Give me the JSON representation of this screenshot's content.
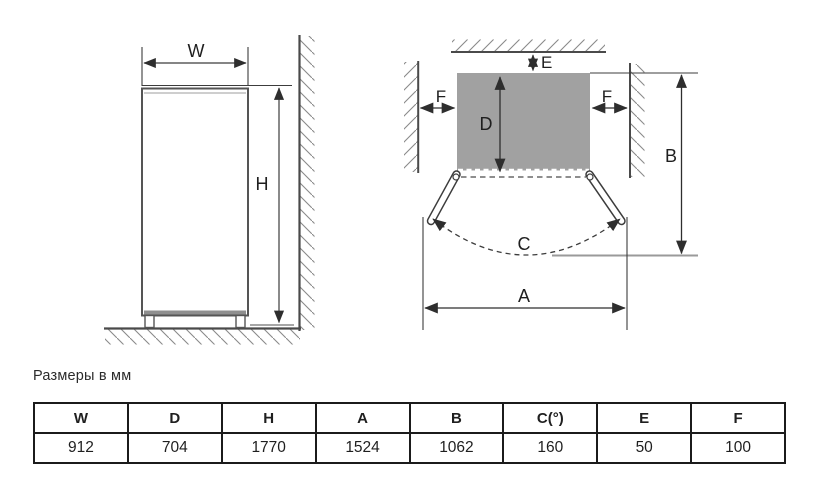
{
  "caption": "Размеры в мм",
  "front_view": {
    "labels": {
      "width": "W",
      "height": "H"
    }
  },
  "top_view": {
    "labels": {
      "a": "A",
      "b": "B",
      "c": "C",
      "d": "D",
      "e": "E",
      "f_left": "F",
      "f_right": "F"
    }
  },
  "table": {
    "headers": [
      "W",
      "D",
      "H",
      "A",
      "B",
      "C(°)",
      "E",
      "F"
    ],
    "values": [
      "912",
      "704",
      "1770",
      "1524",
      "1062",
      "160",
      "50",
      "100"
    ]
  },
  "colors": {
    "fridge_fill": "#a1a1a1",
    "line": "#3c3c3c",
    "wall": "#4a4a4a",
    "hatch": "#8a8a8a",
    "light_line": "#9a9a9a",
    "table_border": "#1b1b1b"
  }
}
